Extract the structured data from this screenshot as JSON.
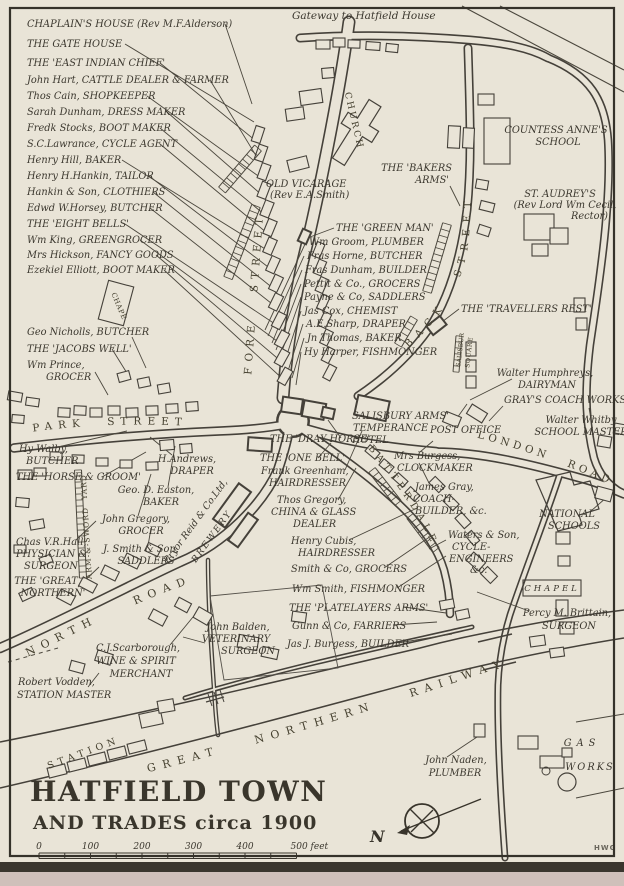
{
  "page": {
    "credit": "HWG"
  },
  "title": {
    "line1": "HATFIELD TOWN",
    "line2": "AND TRADES circa 1900"
  },
  "compass": {
    "north_label": "N"
  },
  "scale_bar": {
    "ticks": [
      "0",
      "100",
      "200",
      "300",
      "400"
    ],
    "end_label": "500 feet"
  },
  "map": {
    "streets": [
      {
        "n": "street-label-fore-street",
        "p": "p-fore",
        "t": "FORE STREET",
        "fs": 10.5,
        "ls": 6,
        "ws": 18
      },
      {
        "n": "street-label-back-street",
        "p": "p-back",
        "t": "BACK STREET",
        "fs": 10,
        "ls": 7,
        "ws": 20
      },
      {
        "n": "street-label-park-street",
        "p": "p-park",
        "t": "PARK STREET",
        "fs": 10.5,
        "ls": 6,
        "ws": 12
      },
      {
        "n": "street-label-north-road",
        "p": "p-north",
        "t": "NORTH ROAD",
        "fs": 11,
        "ls": 7,
        "ws": 30
      },
      {
        "n": "street-label-london-road",
        "p": "p-london",
        "t": "LONDON ROAD",
        "fs": 10.5,
        "ls": 4,
        "ws": 12
      },
      {
        "n": "street-label-batterdale",
        "p": "p-batter",
        "t": "BATTERDALE",
        "fs": 9.5,
        "ls": 5,
        "ws": 0
      },
      {
        "n": "railway-label",
        "p": "p-rail",
        "t": "GREAT NORTHERN RAILWAY",
        "fs": 11,
        "ls": 7,
        "ws": 26
      },
      {
        "n": "station-label",
        "p": "p-station",
        "t": "STATION",
        "fs": 9.5,
        "ls": 4.5,
        "ws": 0
      },
      {
        "n": "arm-sword-yard-label",
        "p": "p-arm",
        "t": "ARM-&-SWORD YARD",
        "fs": 7.5,
        "ls": 1,
        "ws": 4
      },
      {
        "n": "salisbury-square-label-1",
        "p": "p-sq1",
        "t": "SALISBURY",
        "fs": 6.2,
        "ls": 0,
        "ws": 0
      },
      {
        "n": "salisbury-square-label-2",
        "p": "p-sq2",
        "t": "SQUARE",
        "fs": 6.2,
        "ls": 0.5,
        "ws": 0
      },
      {
        "n": "church-label",
        "p": "p-church",
        "t": "CHURCH",
        "fs": 9,
        "ls": 2.5,
        "ws": 0
      },
      {
        "n": "chapel-left-label",
        "p": "p-chapel",
        "t": "CHAPEL",
        "fs": 7,
        "ls": 0.5,
        "ws": 0
      }
    ],
    "labels": [
      {
        "n": "label-chaplains-house",
        "t": "CHAPLAIN'S HOUSE (Rev M.F.Alderson)",
        "x": 27,
        "y": 27
      },
      {
        "n": "label-gate-house",
        "t": "THE GATE HOUSE",
        "x": 27,
        "y": 47
      },
      {
        "n": "label-east-indian-chief",
        "t": "THE 'EAST INDIAN CHIEF'",
        "x": 27,
        "y": 66
      },
      {
        "n": "label-john-hart",
        "t": "John Hart, CATTLE DEALER & FARMER",
        "x": 27,
        "y": 83
      },
      {
        "n": "label-thos-cain",
        "t": "Thos Cain, SHOPKEEPER",
        "x": 27,
        "y": 99
      },
      {
        "n": "label-sarah-dunham",
        "t": "Sarah Dunham, DRESS MAKER",
        "x": 27,
        "y": 115
      },
      {
        "n": "label-fredk-stocks",
        "t": "Fredk Stocks, BOOT MAKER",
        "x": 27,
        "y": 131
      },
      {
        "n": "label-sc-lawrance",
        "t": "S.C.Lawrance, CYCLE AGENT",
        "x": 27,
        "y": 147
      },
      {
        "n": "label-henry-hill",
        "t": "Henry Hill, BAKER",
        "x": 27,
        "y": 163
      },
      {
        "n": "label-henry-hankin",
        "t": "Henry H.Hankin, TAILOR",
        "x": 27,
        "y": 179
      },
      {
        "n": "label-hankin-son",
        "t": "Hankin & Son, CLOTHIERS",
        "x": 27,
        "y": 195
      },
      {
        "n": "label-edwd-horsey",
        "t": "Edwd W.Horsey, BUTCHER",
        "x": 27,
        "y": 211
      },
      {
        "n": "label-eight-bells",
        "t": "THE 'EIGHT BELLS'",
        "x": 27,
        "y": 227
      },
      {
        "n": "label-wm-king",
        "t": "Wm King, GREENGROCER",
        "x": 27,
        "y": 243
      },
      {
        "n": "label-mrs-hickson",
        "t": "Mrs Hickson, FANCY GOODS",
        "x": 27,
        "y": 258
      },
      {
        "n": "label-ezekiel-elliott",
        "t": "Ezekiel Elliott, BOOT MAKER",
        "x": 27,
        "y": 273
      },
      {
        "n": "label-geo-nicholls",
        "t": "Geo Nicholls, BUTCHER",
        "x": 27,
        "y": 335
      },
      {
        "n": "label-jacobs-well",
        "t": "THE 'JACOBS WELL'",
        "x": 27,
        "y": 352
      },
      {
        "n": "label-wm-prince-1",
        "t": "Wm Prince,",
        "x": 27,
        "y": 368
      },
      {
        "n": "label-wm-prince-2",
        "t": "GROCER",
        "x": 46,
        "y": 380
      },
      {
        "n": "label-gateway-hatfield-house",
        "t": "Gateway to Hatfield House",
        "x": 292,
        "y": 19,
        "fs": 10.5
      },
      {
        "n": "label-old-vicarage-1",
        "t": "OLD VICARAGE",
        "x": 266,
        "y": 187
      },
      {
        "n": "label-old-vicarage-2",
        "t": "(Rev E.A.Smith)",
        "x": 270,
        "y": 198
      },
      {
        "n": "label-bakers-arms-1",
        "t": "THE 'BAKERS",
        "x": 452,
        "y": 171,
        "a": "e"
      },
      {
        "n": "label-bakers-arms-2",
        "t": "ARMS'",
        "x": 449,
        "y": 183,
        "a": "e"
      },
      {
        "n": "label-countess-annes-1",
        "t": "COUNTESS ANNE'S",
        "x": 556,
        "y": 133,
        "a": "m"
      },
      {
        "n": "label-countess-annes-2",
        "t": "SCHOOL",
        "x": 558,
        "y": 145,
        "a": "m"
      },
      {
        "n": "label-st-audreys-1",
        "t": "ST. AUDREY'S",
        "x": 560,
        "y": 197,
        "a": "m"
      },
      {
        "n": "label-st-audreys-2",
        "t": "(Rev Lord Wm Cecil,",
        "x": 565,
        "y": 208,
        "a": "m"
      },
      {
        "n": "label-st-audreys-3",
        "t": "Rector)",
        "x": 608,
        "y": 219,
        "a": "e"
      },
      {
        "n": "label-green-man",
        "t": "THE 'GREEN MAN'",
        "x": 336,
        "y": 231
      },
      {
        "n": "label-wm-groom",
        "t": "Wm Groom, PLUMBER",
        "x": 309,
        "y": 245
      },
      {
        "n": "label-fras-horne",
        "t": "Fras Horne, BUTCHER",
        "x": 307,
        "y": 259
      },
      {
        "n": "label-fras-dunham",
        "t": "Fras Dunham, BUILDER",
        "x": 305,
        "y": 273
      },
      {
        "n": "label-pettit-co",
        "t": "Pettit & Co., GROCERS",
        "x": 304,
        "y": 287
      },
      {
        "n": "label-payne-co",
        "t": "Payne & Co, SADDLERS",
        "x": 304,
        "y": 300
      },
      {
        "n": "label-jas-cox",
        "t": "Jas Cox, CHEMIST",
        "x": 304,
        "y": 314
      },
      {
        "n": "label-ae-sharp",
        "t": "A.E.Sharp, DRAPER",
        "x": 306,
        "y": 327
      },
      {
        "n": "label-jn-thomas",
        "t": "Jn Thomas, BAKER",
        "x": 307,
        "y": 341
      },
      {
        "n": "label-hy-harper",
        "t": "Hy Harper, FISHMONGER",
        "x": 304,
        "y": 355
      },
      {
        "n": "label-travellers-rest",
        "t": "THE 'TRAVELLERS REST'",
        "x": 461,
        "y": 312
      },
      {
        "n": "label-walter-humphreys-1",
        "t": "Walter Humphreys,",
        "x": 545,
        "y": 376,
        "a": "m"
      },
      {
        "n": "label-walter-humphreys-2",
        "t": "DAIRYMAN",
        "x": 547,
        "y": 388,
        "a": "m"
      },
      {
        "n": "label-grays-coach-works",
        "t": "GRAY'S COACH WORKS",
        "x": 504,
        "y": 403
      },
      {
        "n": "label-walter-whitby-1",
        "t": "Walter Whitby",
        "x": 581,
        "y": 423,
        "a": "m"
      },
      {
        "n": "label-walter-whitby-2",
        "t": "SCHOOL MASTER",
        "x": 581,
        "y": 435,
        "a": "m"
      },
      {
        "n": "label-salisbury-arms-1",
        "t": "SALISBURY ARMS'",
        "x": 352,
        "y": 419
      },
      {
        "n": "label-salisbury-arms-2",
        "t": "TEMPERANCE",
        "x": 353,
        "y": 431
      },
      {
        "n": "label-salisbury-arms-3",
        "t": "HOTEL",
        "x": 352,
        "y": 443
      },
      {
        "n": "label-post-office",
        "t": "POST OFFICE",
        "x": 430,
        "y": 433
      },
      {
        "n": "label-mrs-burgess-1",
        "t": "Mrs Burgess,",
        "x": 394,
        "y": 459
      },
      {
        "n": "label-mrs-burgess-2",
        "t": "CLOCKMAKER",
        "x": 397,
        "y": 471
      },
      {
        "n": "label-james-gray-1",
        "t": "James Gray,",
        "x": 415,
        "y": 490
      },
      {
        "n": "label-james-gray-2",
        "t": "COACH-",
        "x": 413,
        "y": 502
      },
      {
        "n": "label-james-gray-3",
        "t": "BUILDER, &c.",
        "x": 415,
        "y": 514
      },
      {
        "n": "label-national-schools-1",
        "t": "NATIONAL",
        "x": 567,
        "y": 517,
        "a": "m"
      },
      {
        "n": "label-national-schools-2",
        "t": "SCHOOLS",
        "x": 574,
        "y": 529,
        "a": "m"
      },
      {
        "n": "label-waters-son-1",
        "t": "Waters & Son,",
        "x": 448,
        "y": 538
      },
      {
        "n": "label-waters-son-2",
        "t": "CYCLE-",
        "x": 452,
        "y": 550
      },
      {
        "n": "label-waters-son-3",
        "t": "ENGINEERS",
        "x": 449,
        "y": 562
      },
      {
        "n": "label-waters-son-4",
        "t": "&c.",
        "x": 470,
        "y": 573
      },
      {
        "n": "label-chapel-right",
        "t": "CHAPEL",
        "x": 552,
        "y": 591,
        "a": "m",
        "fs": 8.5,
        "ls": 3
      },
      {
        "n": "label-percy-brittain-1",
        "t": "Percy M. Brittain,",
        "x": 567,
        "y": 616,
        "a": "m"
      },
      {
        "n": "label-percy-brittain-2",
        "t": "SURGEON",
        "x": 569,
        "y": 629,
        "a": "m"
      },
      {
        "n": "label-hy-walby-1",
        "t": "Hy Walby,",
        "x": 19,
        "y": 452
      },
      {
        "n": "label-hy-walby-2",
        "t": "BUTCHER",
        "x": 26,
        "y": 464
      },
      {
        "n": "label-horse-groom",
        "t": "THE 'HORSE & GROOM'",
        "x": 16,
        "y": 480
      },
      {
        "n": "label-h-andrews-1",
        "t": "H.Andrews,",
        "x": 187,
        "y": 462,
        "a": "m"
      },
      {
        "n": "label-h-andrews-2",
        "t": "DRAPER",
        "x": 192,
        "y": 474,
        "a": "m"
      },
      {
        "n": "label-geo-easton-1",
        "t": "Geo. D. Easton,",
        "x": 156,
        "y": 493,
        "a": "m"
      },
      {
        "n": "label-geo-easton-2",
        "t": "BAKER",
        "x": 161,
        "y": 505,
        "a": "m"
      },
      {
        "n": "label-john-gregory-1",
        "t": "John Gregory,",
        "x": 136,
        "y": 522,
        "a": "m"
      },
      {
        "n": "label-john-gregory-2",
        "t": "GROCER",
        "x": 141,
        "y": 534,
        "a": "m"
      },
      {
        "n": "label-chas-hall-1",
        "t": "Chas V.R.Hall,",
        "x": 16,
        "y": 545
      },
      {
        "n": "label-chas-hall-2",
        "t": "PHYSICIAN &",
        "x": 16,
        "y": 557
      },
      {
        "n": "label-chas-hall-3",
        "t": "SURGEON",
        "x": 24,
        "y": 569
      },
      {
        "n": "label-j-smith-son-1",
        "t": "J. Smith & Son,",
        "x": 141,
        "y": 552,
        "a": "m"
      },
      {
        "n": "label-j-smith-son-2",
        "t": "SADDLERS",
        "x": 146,
        "y": 564,
        "a": "m"
      },
      {
        "n": "label-pryor-reid-1",
        "t": "Pryor Reid & Co.Ltd,",
        "x": 198,
        "y": 523,
        "a": "m",
        "r": -54,
        "fs": 9.5
      },
      {
        "n": "label-pryor-reid-2",
        "t": "BREWERY",
        "x": 214,
        "y": 538,
        "a": "m",
        "r": -54,
        "fs": 9,
        "ls": 2
      },
      {
        "n": "label-great-northern-pub-1",
        "t": "THE 'GREAT",
        "x": 46,
        "y": 584,
        "a": "m"
      },
      {
        "n": "label-great-northern-pub-2",
        "t": "NORTHERN'",
        "x": 53,
        "y": 596,
        "a": "m"
      },
      {
        "n": "label-cj-scarborough-1",
        "t": "C.J.Scarborough,",
        "x": 138,
        "y": 651,
        "a": "m"
      },
      {
        "n": "label-cj-scarborough-2",
        "t": "WINE & SPIRIT",
        "x": 136,
        "y": 664,
        "a": "m"
      },
      {
        "n": "label-cj-scarborough-3",
        "t": "MERCHANT",
        "x": 141,
        "y": 677,
        "a": "m"
      },
      {
        "n": "label-robert-vodden-1",
        "t": "Robert Vodden,",
        "x": 18,
        "y": 685
      },
      {
        "n": "label-robert-vodden-2",
        "t": "STATION MASTER",
        "x": 17,
        "y": 698
      },
      {
        "n": "label-john-balden-1",
        "t": "John Balden,",
        "x": 238,
        "y": 630,
        "a": "m"
      },
      {
        "n": "label-john-balden-2",
        "t": "VETERINARY",
        "x": 236,
        "y": 642,
        "a": "m"
      },
      {
        "n": "label-john-balden-3",
        "t": "SURGEON",
        "x": 248,
        "y": 654,
        "a": "m"
      },
      {
        "n": "label-frank-greenham-1",
        "t": "Frank Greenham,",
        "x": 261,
        "y": 474
      },
      {
        "n": "label-frank-greenham-2",
        "t": "HAIRDRESSER",
        "x": 269,
        "y": 486
      },
      {
        "n": "label-thos-gregory-1",
        "t": "Thos Gregory,",
        "x": 277,
        "y": 503
      },
      {
        "n": "label-thos-gregory-2",
        "t": "CHINA & GLASS",
        "x": 271,
        "y": 515
      },
      {
        "n": "label-thos-gregory-3",
        "t": "DEALER",
        "x": 293,
        "y": 527
      },
      {
        "n": "label-dray-horse",
        "t": "THE 'DRAY HORSE'",
        "x": 270,
        "y": 442
      },
      {
        "n": "label-one-bell",
        "t": "THE 'ONE BELL'",
        "x": 260,
        "y": 461
      },
      {
        "n": "label-henry-cubis-1",
        "t": "Henry Cubis,",
        "x": 291,
        "y": 544
      },
      {
        "n": "label-henry-cubis-2",
        "t": "HAIRDRESSER",
        "x": 298,
        "y": 556
      },
      {
        "n": "label-smith-co",
        "t": "Smith & Co, GROCERS",
        "x": 291,
        "y": 572
      },
      {
        "n": "label-wm-smith",
        "t": "Wm Smith, FISHMONGER",
        "x": 292,
        "y": 592
      },
      {
        "n": "label-platelayers-arms",
        "t": "THE 'PLATELAYERS ARMS'",
        "x": 289,
        "y": 611
      },
      {
        "n": "label-gunn-co",
        "t": "Gunn & Co, FARRIERS",
        "x": 292,
        "y": 629
      },
      {
        "n": "label-jas-burgess",
        "t": "Jas J. Burgess, BUILDER",
        "x": 287,
        "y": 647
      },
      {
        "n": "label-john-naden-1",
        "t": "John Naden,",
        "x": 456,
        "y": 763,
        "a": "m"
      },
      {
        "n": "label-john-naden-2",
        "t": "PLUMBER",
        "x": 455,
        "y": 776,
        "a": "m"
      },
      {
        "n": "label-gas",
        "t": "GAS",
        "x": 582,
        "y": 746,
        "a": "m",
        "ls": 5
      },
      {
        "n": "label-gas-works",
        "t": "WORKS",
        "x": 590,
        "y": 770,
        "a": "m",
        "ls": 2
      }
    ]
  }
}
